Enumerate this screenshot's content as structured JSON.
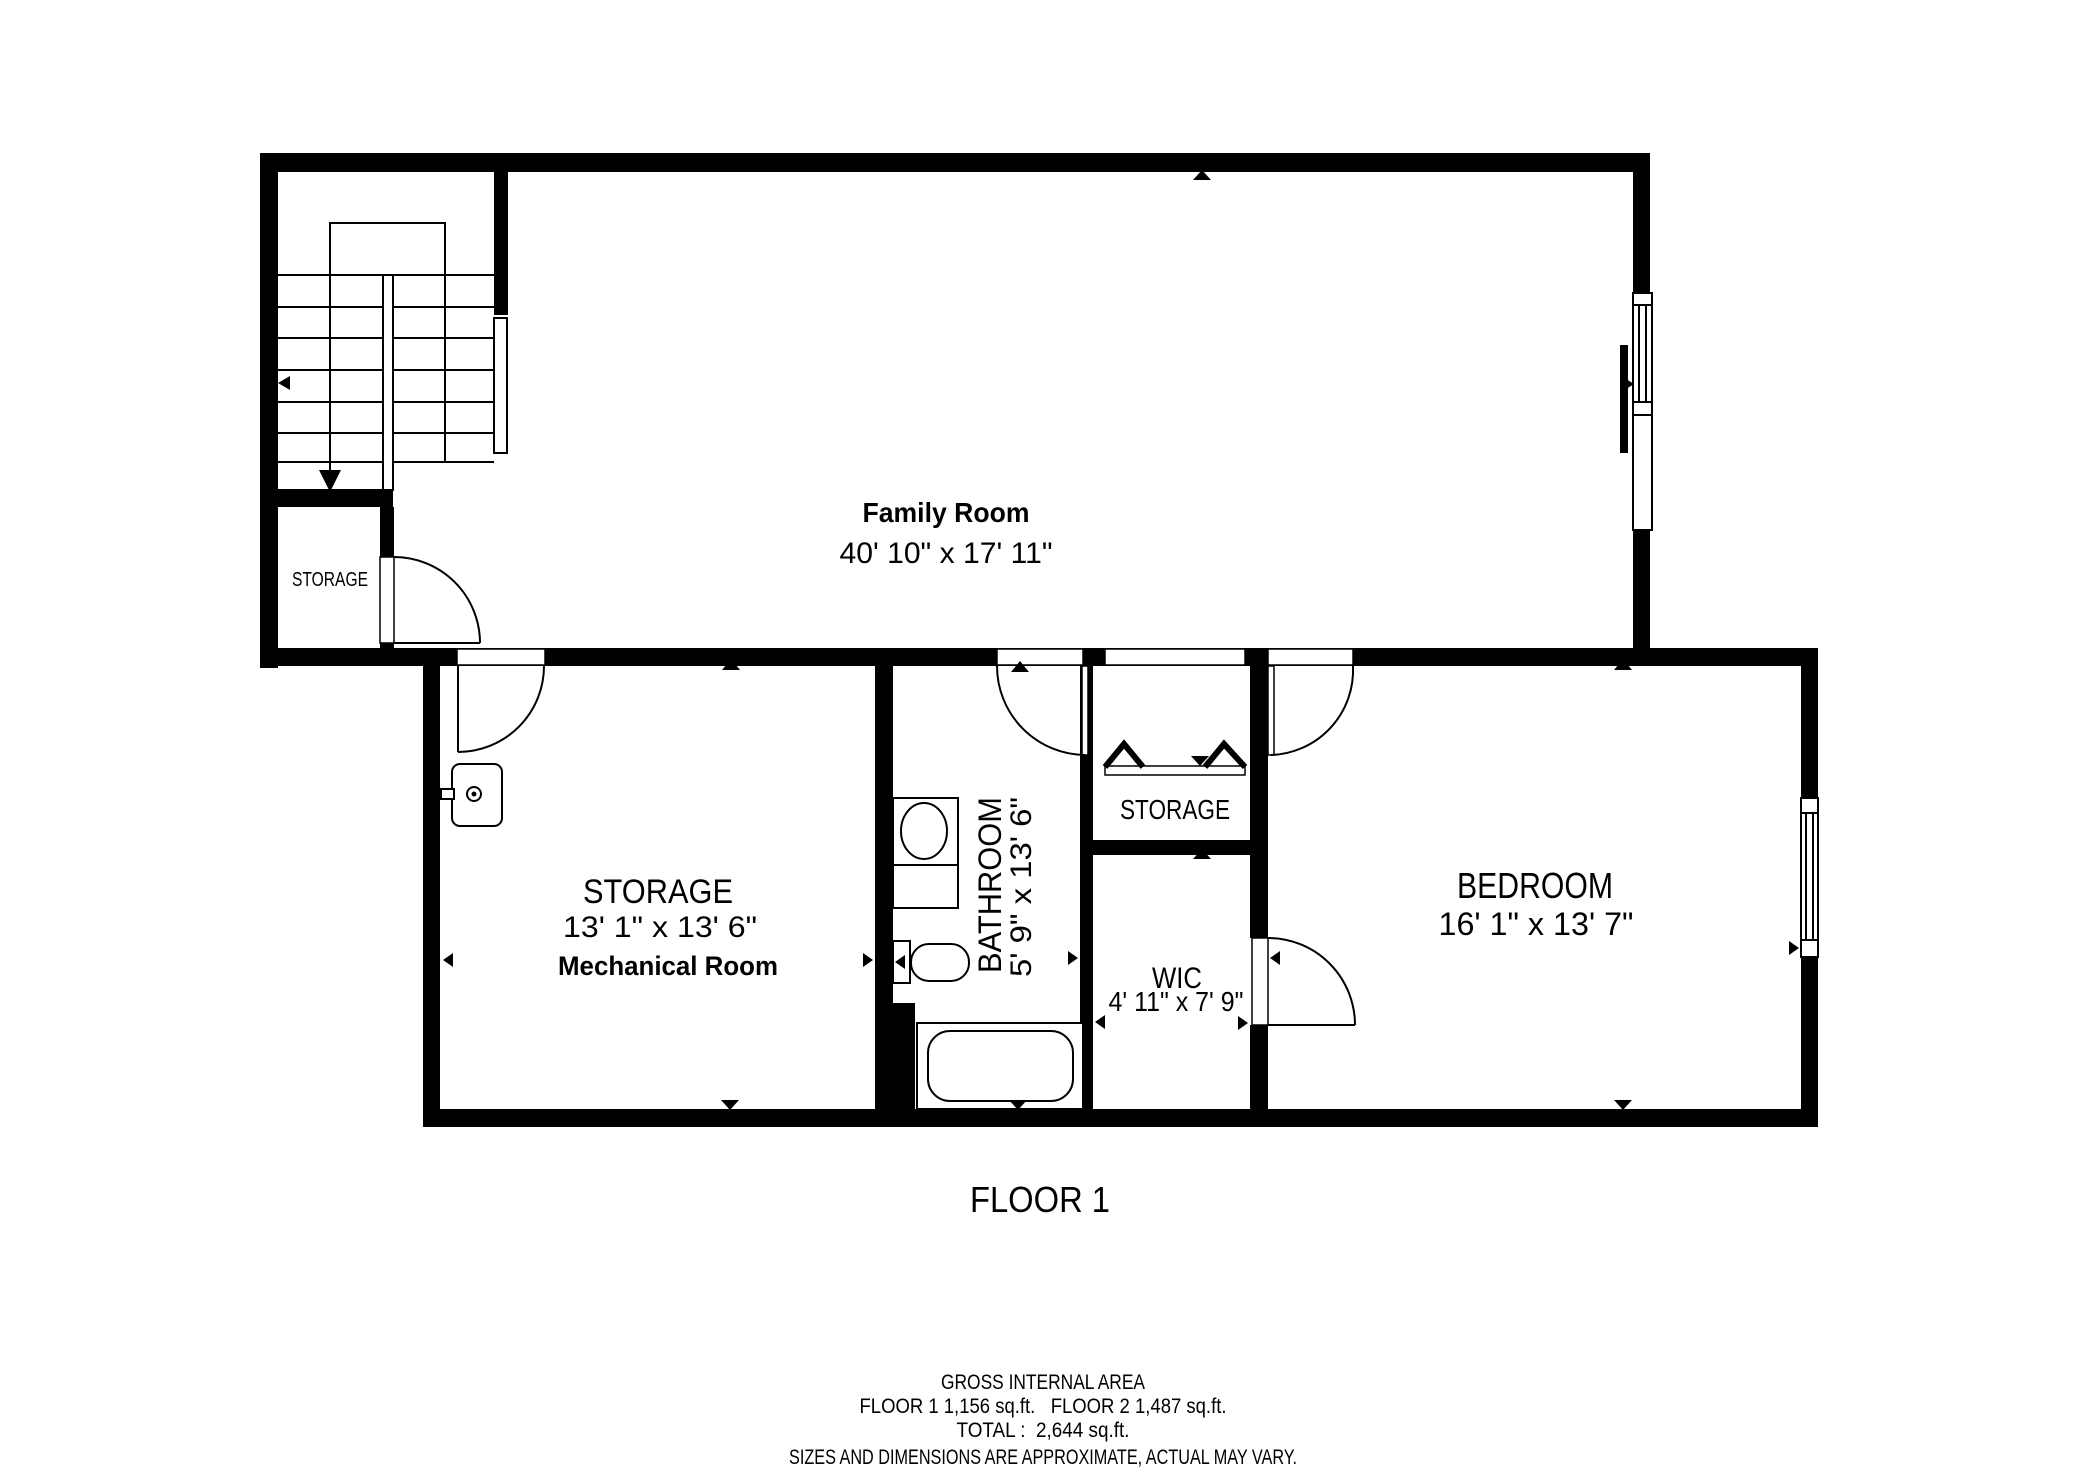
{
  "title": "FLOOR 1",
  "rooms": {
    "family_room": {
      "name": "Family Room",
      "dims": "40' 10\" x 17' 11\""
    },
    "storage_under_stairs": {
      "name": "STORAGE"
    },
    "mechanical": {
      "name": "STORAGE",
      "dims": "13' 1\" x 13' 6\"",
      "subtitle": "Mechanical Room"
    },
    "bathroom": {
      "name": "BATHROOM",
      "dims": "5' 9\" x 13' 6\""
    },
    "closet": {
      "name": "STORAGE"
    },
    "wic": {
      "name": "WIC",
      "dims": "4' 11\" x 7' 9\""
    },
    "bedroom": {
      "name": "BEDROOM",
      "dims": "16' 1\" x 13' 7\""
    }
  },
  "footer": {
    "line1": "GROSS INTERNAL AREA",
    "line2": "FLOOR 1 1,156 sq.ft.   FLOOR 2 1,487 sq.ft.",
    "line3": "TOTAL :  2,644 sq.ft.",
    "line4": "SIZES AND DIMENSIONS ARE APPROXIMATE, ACTUAL MAY VARY."
  },
  "colors": {
    "wall": "#000000",
    "background": "#ffffff",
    "muted": "#848484"
  }
}
